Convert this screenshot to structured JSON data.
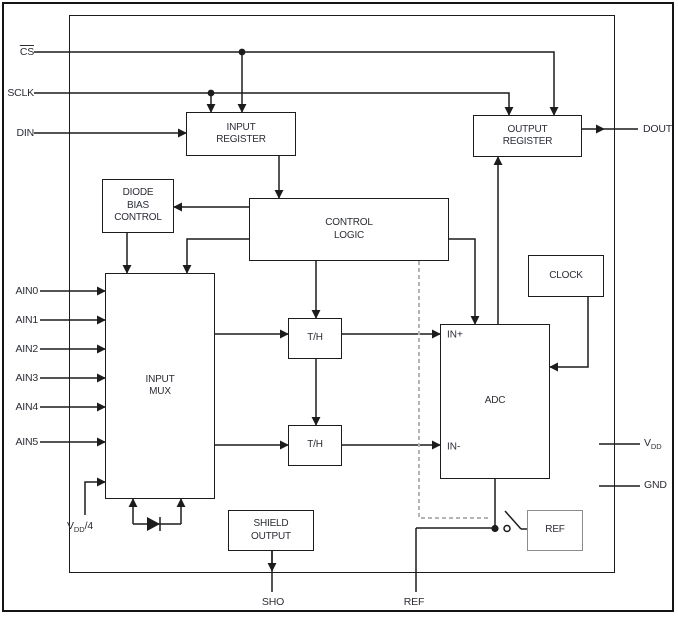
{
  "diagram": {
    "blocks": {
      "input_register": "INPUT\nREGISTER",
      "output_register": "OUTPUT\nREGISTER",
      "diode_bias_control": "DIODE\nBIAS\nCONTROL",
      "control_logic": "CONTROL\nLOGIC",
      "clock": "CLOCK",
      "input_mux": "INPUT\nMUX",
      "th_top": "T/H",
      "th_bottom": "T/H",
      "adc": "ADC",
      "adc_in_plus": "IN+",
      "adc_in_minus": "IN-",
      "shield_output": "SHIELD\nOUTPUT",
      "ref_block": "REF"
    },
    "pins": {
      "cs": "CS",
      "sclk": "SCLK",
      "din": "DIN",
      "ain": [
        "AIN0",
        "AIN1",
        "AIN2",
        "AIN3",
        "AIN4",
        "AIN5"
      ],
      "vdd4": {
        "pre": "V",
        "sub": "DD",
        "post": "/4"
      },
      "dout": "DOUT",
      "vdd": {
        "pre": "V",
        "sub": "DD",
        "post": ""
      },
      "gnd": "GND",
      "sho": "SHO",
      "ref": "REF"
    },
    "colors": {
      "wire": "#1c1c1c",
      "text": "#2b2d36",
      "dashed_wire": "#b4b4b4",
      "ref_block_border": "#8c8c8c",
      "background": "#ffffff"
    }
  }
}
